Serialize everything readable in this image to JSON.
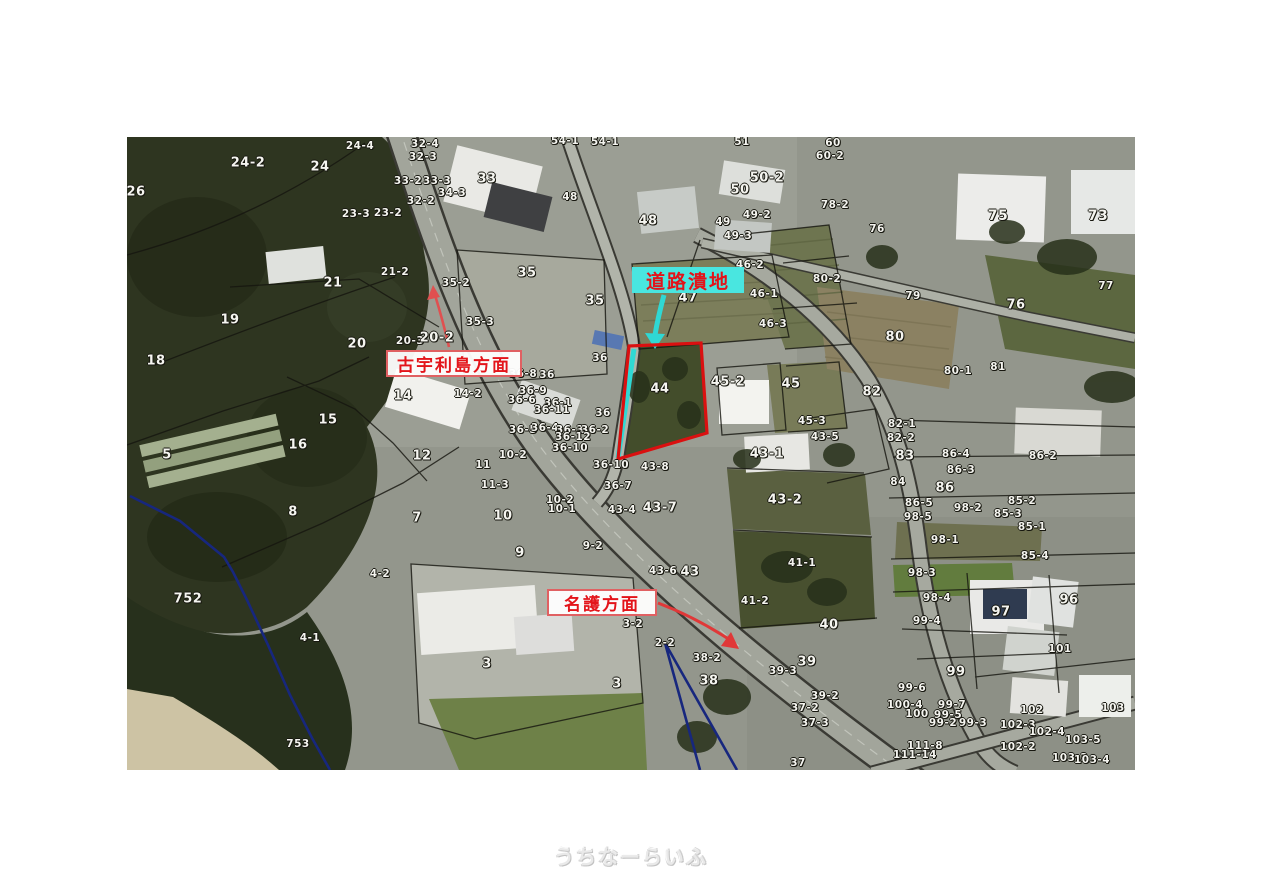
{
  "watermark": {
    "text": "うちなーらいふ"
  },
  "map": {
    "annotations": {
      "road_ruin_label": "道路潰地",
      "kouri_label": "古宇利島方面",
      "nago_label": "名護方面"
    },
    "highlight": {
      "parcel": "44",
      "outline_color": "#da1010",
      "edge_color": "#2fd8d4"
    },
    "colors": {
      "annotation_red": "#e3141a",
      "annotation_cyan_bg": "#49e6e0",
      "boundary_navy": "#17277e",
      "boundary_black": "#15150f"
    },
    "parcels": [
      {
        "t": "26",
        "x": 9,
        "y": 55,
        "s": 13
      },
      {
        "t": "24-2",
        "x": 121,
        "y": 26,
        "s": 13
      },
      {
        "t": "24",
        "x": 193,
        "y": 30,
        "s": 13
      },
      {
        "t": "24-4",
        "x": 233,
        "y": 9
      },
      {
        "t": "32-4",
        "x": 298,
        "y": 7
      },
      {
        "t": "32-3",
        "x": 296,
        "y": 20
      },
      {
        "t": "33-2",
        "x": 281,
        "y": 44
      },
      {
        "t": "33-3",
        "x": 310,
        "y": 44
      },
      {
        "t": "33",
        "x": 360,
        "y": 42,
        "s": 13
      },
      {
        "t": "34-3",
        "x": 325,
        "y": 56
      },
      {
        "t": "32-2",
        "x": 294,
        "y": 64
      },
      {
        "t": "23-3",
        "x": 229,
        "y": 77
      },
      {
        "t": "23-2",
        "x": 261,
        "y": 76
      },
      {
        "t": "54-1",
        "x": 438,
        "y": 4
      },
      {
        "t": "54-1",
        "x": 478,
        "y": 5
      },
      {
        "t": "48",
        "x": 443,
        "y": 60
      },
      {
        "t": "48",
        "x": 521,
        "y": 84,
        "s": 13
      },
      {
        "t": "51",
        "x": 615,
        "y": 5
      },
      {
        "t": "60",
        "x": 706,
        "y": 6
      },
      {
        "t": "60-2",
        "x": 703,
        "y": 19
      },
      {
        "t": "50-2",
        "x": 640,
        "y": 41,
        "s": 13
      },
      {
        "t": "50",
        "x": 613,
        "y": 53,
        "s": 13
      },
      {
        "t": "49-2",
        "x": 630,
        "y": 78
      },
      {
        "t": "49",
        "x": 596,
        "y": 85
      },
      {
        "t": "49-3",
        "x": 611,
        "y": 99
      },
      {
        "t": "78-2",
        "x": 708,
        "y": 68
      },
      {
        "t": "76",
        "x": 750,
        "y": 92
      },
      {
        "t": "75",
        "x": 871,
        "y": 79,
        "s": 14
      },
      {
        "t": "73",
        "x": 971,
        "y": 79,
        "s": 14
      },
      {
        "t": "77",
        "x": 979,
        "y": 149
      },
      {
        "t": "46-2",
        "x": 623,
        "y": 128
      },
      {
        "t": "47",
        "x": 561,
        "y": 161,
        "s": 13
      },
      {
        "t": "46-1",
        "x": 637,
        "y": 157
      },
      {
        "t": "46-3",
        "x": 646,
        "y": 187
      },
      {
        "t": "80-2",
        "x": 700,
        "y": 142
      },
      {
        "t": "79",
        "x": 786,
        "y": 159
      },
      {
        "t": "76",
        "x": 889,
        "y": 168,
        "s": 13
      },
      {
        "t": "80",
        "x": 768,
        "y": 200,
        "s": 13
      },
      {
        "t": "80-1",
        "x": 831,
        "y": 234
      },
      {
        "t": "81",
        "x": 871,
        "y": 230
      },
      {
        "t": "82",
        "x": 745,
        "y": 255,
        "s": 13
      },
      {
        "t": "21-2",
        "x": 268,
        "y": 135
      },
      {
        "t": "21",
        "x": 206,
        "y": 146,
        "s": 13
      },
      {
        "t": "35-2",
        "x": 329,
        "y": 146
      },
      {
        "t": "35",
        "x": 400,
        "y": 136,
        "s": 13
      },
      {
        "t": "35-3",
        "x": 353,
        "y": 185
      },
      {
        "t": "20",
        "x": 230,
        "y": 207,
        "s": 13
      },
      {
        "t": "20-3",
        "x": 283,
        "y": 204
      },
      {
        "t": "20-2",
        "x": 310,
        "y": 201,
        "s": 13
      },
      {
        "t": "35",
        "x": 468,
        "y": 164,
        "s": 13
      },
      {
        "t": "36",
        "x": 473,
        "y": 221
      },
      {
        "t": "19",
        "x": 103,
        "y": 183,
        "s": 13
      },
      {
        "t": "18",
        "x": 29,
        "y": 224,
        "s": 13
      },
      {
        "t": "14",
        "x": 276,
        "y": 259,
        "s": 13
      },
      {
        "t": "14-2",
        "x": 341,
        "y": 257
      },
      {
        "t": "15",
        "x": 201,
        "y": 283,
        "s": 13
      },
      {
        "t": "16",
        "x": 171,
        "y": 308,
        "s": 13
      },
      {
        "t": "36-8",
        "x": 396,
        "y": 237
      },
      {
        "t": "36",
        "x": 420,
        "y": 238
      },
      {
        "t": "36-9",
        "x": 406,
        "y": 254
      },
      {
        "t": "36-6",
        "x": 395,
        "y": 263
      },
      {
        "t": "36-1",
        "x": 431,
        "y": 266
      },
      {
        "t": "36-11",
        "x": 425,
        "y": 273
      },
      {
        "t": "36",
        "x": 476,
        "y": 276
      },
      {
        "t": "44",
        "x": 533,
        "y": 252,
        "s": 13
      },
      {
        "t": "45-2",
        "x": 601,
        "y": 245,
        "s": 13
      },
      {
        "t": "45",
        "x": 664,
        "y": 247,
        "s": 13
      },
      {
        "t": "45-3",
        "x": 685,
        "y": 284
      },
      {
        "t": "43-5",
        "x": 698,
        "y": 300
      },
      {
        "t": "43-1",
        "x": 640,
        "y": 317,
        "s": 13
      },
      {
        "t": "43-2",
        "x": 658,
        "y": 363,
        "s": 13
      },
      {
        "t": "36-5",
        "x": 396,
        "y": 293
      },
      {
        "t": "36-4",
        "x": 418,
        "y": 291
      },
      {
        "t": "36-3",
        "x": 443,
        "y": 293
      },
      {
        "t": "36-2",
        "x": 468,
        "y": 293
      },
      {
        "t": "36-12",
        "x": 446,
        "y": 300
      },
      {
        "t": "36-10",
        "x": 443,
        "y": 311
      },
      {
        "t": "36-10",
        "x": 484,
        "y": 328
      },
      {
        "t": "43-8",
        "x": 528,
        "y": 330
      },
      {
        "t": "36-7",
        "x": 491,
        "y": 349
      },
      {
        "t": "10-2",
        "x": 386,
        "y": 318
      },
      {
        "t": "11-3",
        "x": 368,
        "y": 348
      },
      {
        "t": "12",
        "x": 295,
        "y": 319,
        "s": 13
      },
      {
        "t": "11",
        "x": 356,
        "y": 328
      },
      {
        "t": "10",
        "x": 376,
        "y": 379,
        "s": 13
      },
      {
        "t": "10-2",
        "x": 433,
        "y": 363
      },
      {
        "t": "10-1",
        "x": 435,
        "y": 372
      },
      {
        "t": "43-4",
        "x": 495,
        "y": 373
      },
      {
        "t": "43-7",
        "x": 533,
        "y": 371,
        "s": 13
      },
      {
        "t": "8",
        "x": 166,
        "y": 375,
        "s": 13
      },
      {
        "t": "5",
        "x": 40,
        "y": 318,
        "s": 13
      },
      {
        "t": "7",
        "x": 290,
        "y": 381,
        "s": 13
      },
      {
        "t": "9",
        "x": 393,
        "y": 416,
        "s": 13
      },
      {
        "t": "9-2",
        "x": 466,
        "y": 409
      },
      {
        "t": "4-2",
        "x": 253,
        "y": 437
      },
      {
        "t": "752",
        "x": 61,
        "y": 462,
        "s": 13
      },
      {
        "t": "4-1",
        "x": 183,
        "y": 501
      },
      {
        "t": "753",
        "x": 171,
        "y": 607
      },
      {
        "t": "3",
        "x": 360,
        "y": 527,
        "s": 13
      },
      {
        "t": "3",
        "x": 490,
        "y": 547,
        "s": 13
      },
      {
        "t": "3-2",
        "x": 506,
        "y": 487
      },
      {
        "t": "2-2",
        "x": 538,
        "y": 506
      },
      {
        "t": "43-6",
        "x": 536,
        "y": 434
      },
      {
        "t": "43",
        "x": 563,
        "y": 435,
        "s": 13
      },
      {
        "t": "38-2",
        "x": 580,
        "y": 521
      },
      {
        "t": "38",
        "x": 582,
        "y": 544,
        "s": 13
      },
      {
        "t": "39-3",
        "x": 656,
        "y": 534
      },
      {
        "t": "39",
        "x": 680,
        "y": 525,
        "s": 13
      },
      {
        "t": "40",
        "x": 702,
        "y": 488,
        "s": 13
      },
      {
        "t": "39-2",
        "x": 698,
        "y": 559
      },
      {
        "t": "37-2",
        "x": 678,
        "y": 571
      },
      {
        "t": "37-3",
        "x": 688,
        "y": 586
      },
      {
        "t": "37",
        "x": 671,
        "y": 626
      },
      {
        "t": "41-1",
        "x": 675,
        "y": 426
      },
      {
        "t": "41-2",
        "x": 628,
        "y": 464
      },
      {
        "t": "82-1",
        "x": 775,
        "y": 287
      },
      {
        "t": "82-2",
        "x": 774,
        "y": 301
      },
      {
        "t": "83",
        "x": 778,
        "y": 319,
        "s": 13
      },
      {
        "t": "86-4",
        "x": 829,
        "y": 317
      },
      {
        "t": "86-2",
        "x": 916,
        "y": 319
      },
      {
        "t": "86-3",
        "x": 834,
        "y": 333
      },
      {
        "t": "84",
        "x": 771,
        "y": 345
      },
      {
        "t": "86",
        "x": 818,
        "y": 351,
        "s": 13
      },
      {
        "t": "86-5",
        "x": 792,
        "y": 366
      },
      {
        "t": "85-2",
        "x": 895,
        "y": 364
      },
      {
        "t": "98-2",
        "x": 841,
        "y": 371
      },
      {
        "t": "98-5",
        "x": 791,
        "y": 380
      },
      {
        "t": "85-3",
        "x": 881,
        "y": 377
      },
      {
        "t": "85-1",
        "x": 905,
        "y": 390
      },
      {
        "t": "98-1",
        "x": 818,
        "y": 403
      },
      {
        "t": "85-4",
        "x": 908,
        "y": 419
      },
      {
        "t": "98-3",
        "x": 795,
        "y": 436
      },
      {
        "t": "98-4",
        "x": 810,
        "y": 461
      },
      {
        "t": "99-4",
        "x": 800,
        "y": 484
      },
      {
        "t": "97",
        "x": 874,
        "y": 475,
        "s": 13
      },
      {
        "t": "96",
        "x": 942,
        "y": 463,
        "s": 13
      },
      {
        "t": "99",
        "x": 829,
        "y": 535,
        "s": 13
      },
      {
        "t": "99-6",
        "x": 785,
        "y": 551
      },
      {
        "t": "101",
        "x": 933,
        "y": 512
      },
      {
        "t": "100-4",
        "x": 778,
        "y": 568
      },
      {
        "t": "100",
        "x": 790,
        "y": 577
      },
      {
        "t": "99-7",
        "x": 825,
        "y": 568
      },
      {
        "t": "99-5",
        "x": 821,
        "y": 578
      },
      {
        "t": "99-2",
        "x": 816,
        "y": 586
      },
      {
        "t": "99-3",
        "x": 846,
        "y": 586
      },
      {
        "t": "102",
        "x": 905,
        "y": 573
      },
      {
        "t": "102-3",
        "x": 891,
        "y": 588
      },
      {
        "t": "102-4",
        "x": 920,
        "y": 595
      },
      {
        "t": "102-2",
        "x": 891,
        "y": 610
      },
      {
        "t": "103",
        "x": 986,
        "y": 571
      },
      {
        "t": "103-5",
        "x": 956,
        "y": 603
      },
      {
        "t": "103-3",
        "x": 943,
        "y": 621
      },
      {
        "t": "103-4",
        "x": 965,
        "y": 623
      },
      {
        "t": "111-8",
        "x": 798,
        "y": 609
      },
      {
        "t": "111-14",
        "x": 788,
        "y": 618
      }
    ]
  }
}
